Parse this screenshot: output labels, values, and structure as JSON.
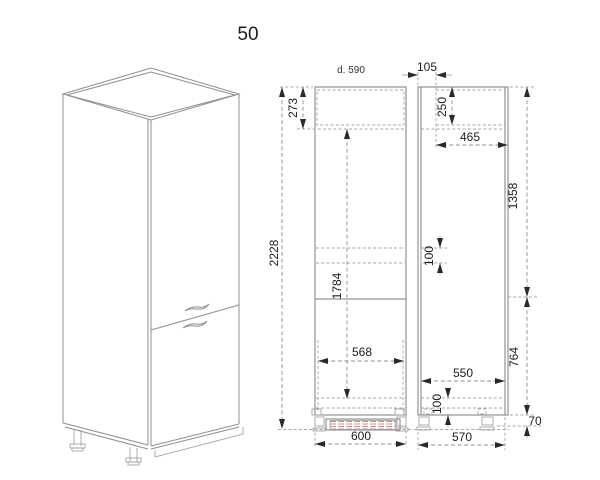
{
  "title": "50",
  "front_view": {
    "overall_height": "2228",
    "top_section": "273",
    "door_height": "1784",
    "interior_width": "568",
    "overall_width": "600"
  },
  "side_view": {
    "depth_label": "d. 590",
    "back_offset": "105",
    "top_compartment": "250",
    "interior_depth": "465",
    "upper_height": "1358",
    "shelf_clearance": "100",
    "clear_depth": "550",
    "lower_height": "764",
    "bottom_clearance": "100",
    "foot_height": "70",
    "carcass_depth": "570"
  }
}
